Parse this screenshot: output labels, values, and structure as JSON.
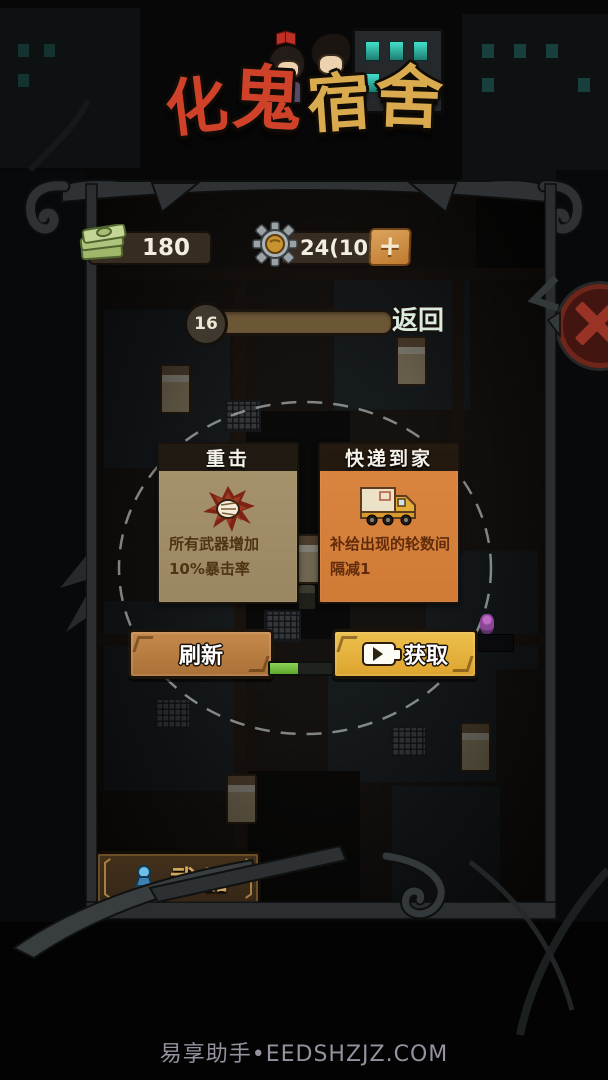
{
  "app": {
    "watermark": "易享助手•EEDSHZJZ.COM"
  },
  "logo": {
    "chars": [
      "化",
      "鬼",
      "宿",
      "舍"
    ]
  },
  "hud": {
    "money": "180",
    "gear": "24(109)",
    "plus": "+",
    "round": "16",
    "back": "返回"
  },
  "cards": [
    {
      "title": "重击",
      "icon": "fist-impact-icon",
      "desc_lines": [
        "所有武器增加",
        "10%暴击率"
      ]
    },
    {
      "title": "快递到家",
      "icon": "delivery-truck-icon",
      "desc_lines": [
        "补给出现的轮数间",
        "隔减1"
      ]
    }
  ],
  "actions": {
    "refresh": "刷新",
    "get": "获取",
    "ad_progress_percent": 45
  },
  "weapon": {
    "label": "武器"
  },
  "colors": {
    "card_tan": "#a7946d",
    "card_orange": "#db8741",
    "button_gold": "#eec04e",
    "button_copper": "#c68a4c",
    "progress_green": "#6fc23d",
    "logo_red": "#cf4229",
    "logo_gold": "#d9ab4e"
  }
}
